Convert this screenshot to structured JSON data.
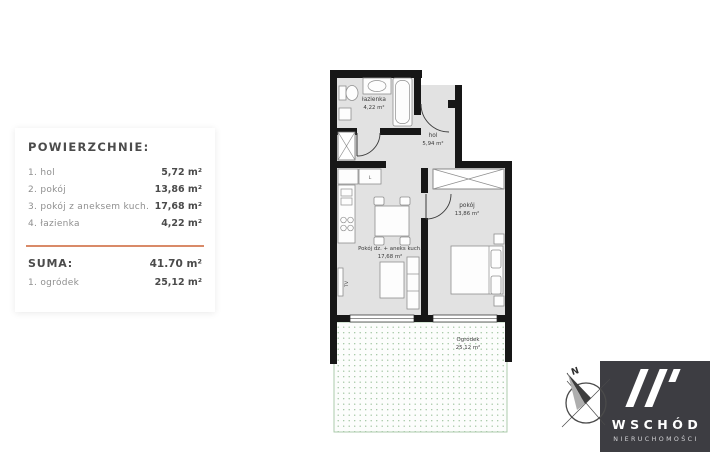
{
  "panel": {
    "title": "POWIERZCHNIE:",
    "items": [
      {
        "label": "1. hol",
        "value": "5,72 m²"
      },
      {
        "label": "2. pokój",
        "value": "13,86 m²"
      },
      {
        "label": "3. pokój z aneksem kuch.",
        "value": "17,68 m²"
      },
      {
        "label": "4. łazienka",
        "value": "4,22 m²"
      }
    ],
    "suma": {
      "label": "SUMA:",
      "value": "41.70 m²"
    },
    "ogrodek": {
      "label": "1. ogródek",
      "value": "25,12 m²"
    }
  },
  "plan": {
    "rooms": {
      "lazienka": {
        "name": "łazienka",
        "area": "4,22 m²"
      },
      "hol": {
        "name": "hol",
        "area": "5,94 m²"
      },
      "pokoj": {
        "name": "pokój",
        "area": "13,86 m²"
      },
      "salon": {
        "name": "Pokój dz. + aneks kuch.",
        "area": "17,68 m²"
      },
      "ogrodek": {
        "name": "Ogródek",
        "area": "25,12 m²"
      }
    },
    "fixtures": {
      "tv": "TV",
      "fridge": "L"
    }
  },
  "compass": {
    "north": "N"
  },
  "logo": {
    "name": "WSCHÓD",
    "subtitle": "NIERUCHOMOŚCI"
  },
  "colors": {
    "accent": "#d98a68",
    "wall": "#171717",
    "floor": "#e2e2e2",
    "garden_dot": "#9dc39d",
    "logo_bg": "#3d3d42"
  }
}
